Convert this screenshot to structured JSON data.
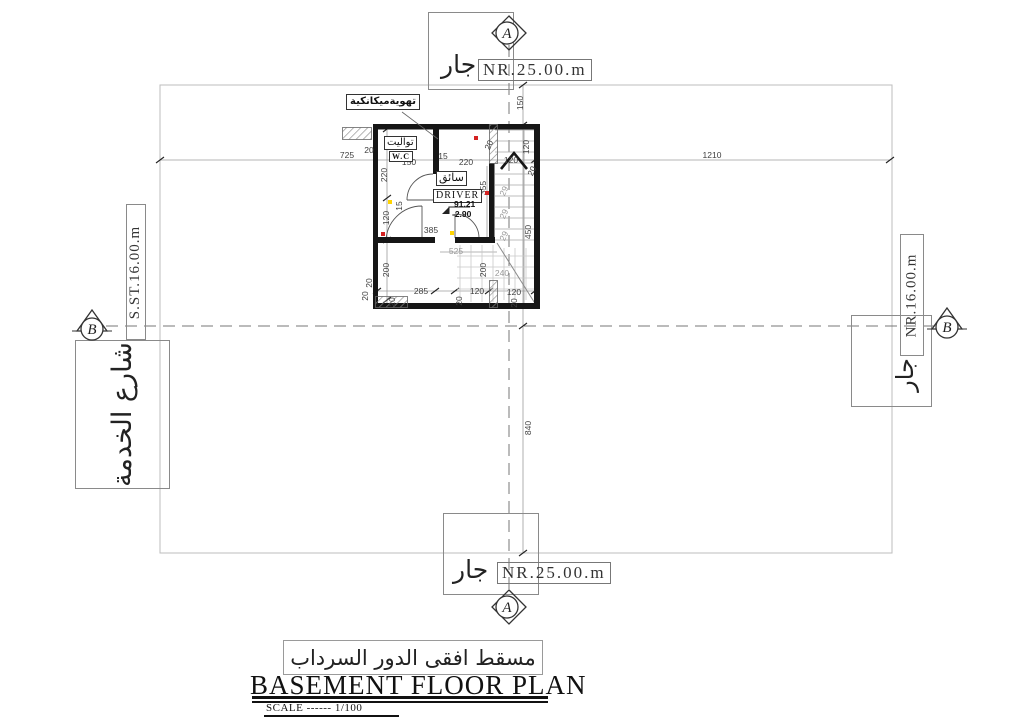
{
  "title_block": {
    "arabic_title": "مسقط افقى الدور السرداب",
    "english_title": "BASEMENT FLOOR PLAN",
    "scale_label": "SCALE ------ 1/100"
  },
  "boundary_labels": {
    "top": {
      "neighbor": "جار",
      "value": "NR.25.00.m"
    },
    "bottom": {
      "neighbor": "جار",
      "value": "NR.25.00.m"
    },
    "left": {
      "street_width": "S.ST.16.00.m",
      "street_name": "شارع الخدمة"
    },
    "right": {
      "value": "NR.16.00.m",
      "neighbor": "جار"
    }
  },
  "section_markers": {
    "top": "A",
    "bottom": "A",
    "left": "B",
    "right": "B"
  },
  "rooms": {
    "vent_note": "تهويةميكانكية",
    "wc": {
      "arabic": "تواليت",
      "latin": "W.C"
    },
    "driver": {
      "arabic": "سائق",
      "latin": "DRIVER"
    },
    "level": {
      "elevation": "91.21",
      "depth": "-2.90"
    }
  },
  "colors": {
    "wall": "#161616",
    "dim_text": "#3e3e3e",
    "light_text": "#9a9a9a",
    "red_marker": "#d42222",
    "yellow_marker": "#ffd400"
  },
  "dimensions": [
    {
      "t": "725",
      "x": 347,
      "y": 155
    },
    {
      "t": "1210",
      "x": 712,
      "y": 155
    },
    {
      "t": "150",
      "x": 520,
      "y": 103,
      "r": -90
    },
    {
      "t": "840",
      "x": 528,
      "y": 428,
      "r": -90
    },
    {
      "t": "20",
      "x": 369,
      "y": 150
    },
    {
      "t": "150",
      "x": 409,
      "y": 162
    },
    {
      "t": "15",
      "x": 443,
      "y": 156
    },
    {
      "t": "220",
      "x": 466,
      "y": 162
    },
    {
      "t": "20",
      "x": 489,
      "y": 145,
      "r": -65
    },
    {
      "t": "120",
      "x": 511,
      "y": 160
    },
    {
      "t": "20",
      "x": 532,
      "y": 171,
      "r": -65
    },
    {
      "t": "120",
      "x": 526,
      "y": 147,
      "r": -90
    },
    {
      "t": "220",
      "x": 384,
      "y": 175,
      "r": -90
    },
    {
      "t": "15",
      "x": 399,
      "y": 206,
      "r": -90
    },
    {
      "t": "120",
      "x": 386,
      "y": 218,
      "r": -90
    },
    {
      "t": "200",
      "x": 386,
      "y": 270,
      "r": -90
    },
    {
      "t": "20",
      "x": 369,
      "y": 283,
      "r": -90
    },
    {
      "t": "385",
      "x": 431,
      "y": 230
    },
    {
      "t": "355",
      "x": 483,
      "y": 188,
      "r": -90
    },
    {
      "t": "525",
      "x": 456,
      "y": 251,
      "l": 1
    },
    {
      "t": "200",
      "x": 483,
      "y": 270,
      "r": -90
    },
    {
      "t": "240",
      "x": 502,
      "y": 273,
      "l": 1
    },
    {
      "t": "450",
      "x": 528,
      "y": 232,
      "r": -90
    },
    {
      "t": "29",
      "x": 504,
      "y": 191,
      "r": -65,
      "l": 1
    },
    {
      "t": "29",
      "x": 504,
      "y": 214,
      "r": -65,
      "l": 1
    },
    {
      "t": "29",
      "x": 504,
      "y": 236,
      "r": -65,
      "l": 1
    },
    {
      "t": "285",
      "x": 421,
      "y": 291
    },
    {
      "t": "120",
      "x": 477,
      "y": 291
    },
    {
      "t": "120",
      "x": 514,
      "y": 292
    },
    {
      "t": "20",
      "x": 392,
      "y": 302,
      "r": -90
    },
    {
      "t": "20",
      "x": 459,
      "y": 301,
      "r": -90
    },
    {
      "t": "20",
      "x": 514,
      "y": 303,
      "r": -90
    },
    {
      "t": "20",
      "x": 365,
      "y": 296,
      "r": -90
    }
  ],
  "dots": [
    {
      "x": 476,
      "y": 138,
      "c": "#d42222"
    },
    {
      "x": 487,
      "y": 193,
      "c": "#d42222"
    },
    {
      "x": 383,
      "y": 234,
      "c": "#d42222"
    },
    {
      "x": 390,
      "y": 202,
      "c": "#ffd400"
    },
    {
      "x": 452,
      "y": 233,
      "c": "#ffd400"
    }
  ]
}
